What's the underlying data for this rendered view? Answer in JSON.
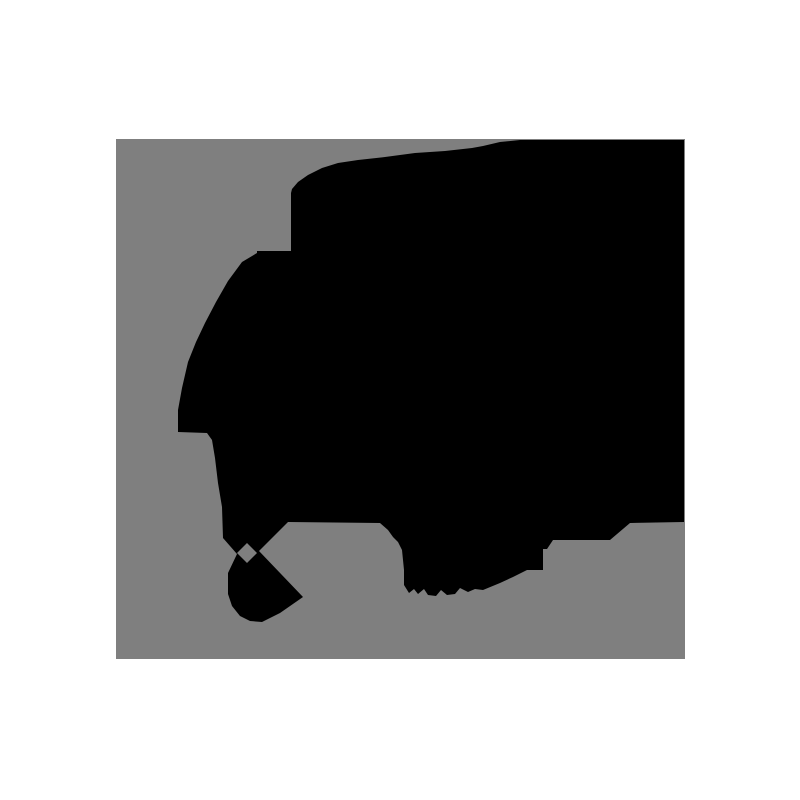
{
  "image": {
    "description": "binary segmentation-style mask: black silhouette on gray field centered on white canvas",
    "canvas": {
      "width": 800,
      "height": 800,
      "background_color": "#ffffff"
    },
    "mask_area": {
      "x": 116,
      "y": 139,
      "width": 569,
      "height": 520,
      "background_color": "#7f7f7f"
    },
    "silhouette": {
      "fill_color": "#000000",
      "outer_polygon": [
        [
          176,
          50
        ],
        [
          182,
          43
        ],
        [
          192,
          36
        ],
        [
          206,
          29
        ],
        [
          222,
          24
        ],
        [
          242,
          21
        ],
        [
          269,
          18
        ],
        [
          299,
          14
        ],
        [
          329,
          12
        ],
        [
          356,
          9
        ],
        [
          367,
          7
        ],
        [
          384,
          3
        ],
        [
          404,
          1
        ],
        [
          568,
          1
        ],
        [
          568,
          383
        ],
        [
          514,
          384
        ],
        [
          494,
          401
        ],
        [
          437,
          401
        ],
        [
          431,
          410
        ],
        [
          427,
          410
        ],
        [
          427,
          431
        ],
        [
          411,
          431
        ],
        [
          397,
          438
        ],
        [
          384,
          444
        ],
        [
          367,
          451
        ],
        [
          359,
          450
        ],
        [
          352,
          453
        ],
        [
          344,
          449
        ],
        [
          339,
          455
        ],
        [
          331,
          456
        ],
        [
          325,
          451
        ],
        [
          320,
          457
        ],
        [
          312,
          456
        ],
        [
          308,
          450
        ],
        [
          302,
          455
        ],
        [
          298,
          450
        ],
        [
          293,
          454
        ],
        [
          288,
          446
        ],
        [
          288,
          431
        ],
        [
          286,
          411
        ],
        [
          282,
          403
        ],
        [
          277,
          398
        ],
        [
          272,
          391
        ],
        [
          264,
          384
        ],
        [
          172,
          383
        ],
        [
          143,
          412
        ],
        [
          187,
          458
        ],
        [
          164,
          474
        ],
        [
          146,
          483
        ],
        [
          134,
          482
        ],
        [
          124,
          477
        ],
        [
          116,
          467
        ],
        [
          112,
          455
        ],
        [
          112,
          434
        ],
        [
          121,
          415
        ],
        [
          107,
          399
        ],
        [
          106,
          368
        ],
        [
          102,
          344
        ],
        [
          99,
          319
        ],
        [
          96,
          301
        ],
        [
          91,
          294
        ],
        [
          62,
          293
        ],
        [
          62,
          271
        ],
        [
          66,
          249
        ],
        [
          72,
          223
        ],
        [
          80,
          203
        ],
        [
          89,
          184
        ],
        [
          100,
          163
        ],
        [
          112,
          142
        ],
        [
          126,
          123
        ],
        [
          141,
          114
        ],
        [
          141,
          112
        ],
        [
          175,
          112
        ],
        [
          175,
          54
        ]
      ],
      "diamond_hole": [
        [
          131,
          404
        ],
        [
          141,
          414
        ],
        [
          131,
          424
        ],
        [
          121,
          414
        ]
      ]
    }
  }
}
